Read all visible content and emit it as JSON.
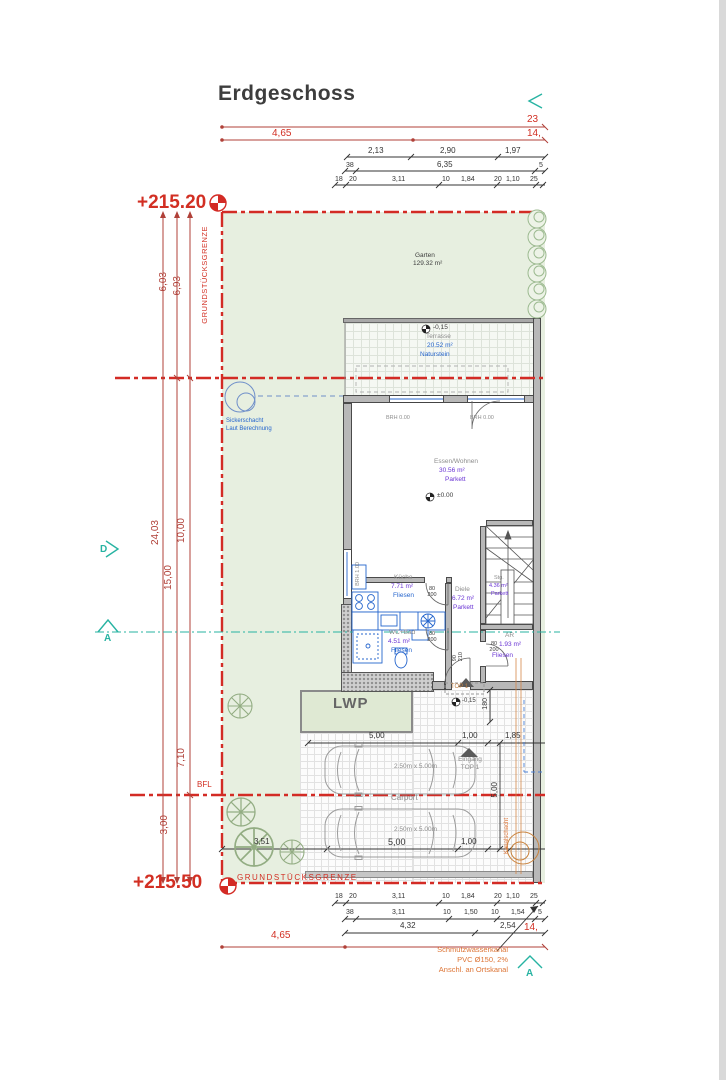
{
  "title": "Erdgeschoss",
  "elevation": {
    "top": "+215.20",
    "bottom": "+215.50"
  },
  "boundary": {
    "label_vertical": "GRUNDSTÜCKSGRENZE",
    "label_bottom": "GRUNDSTÜCKSGRENZE",
    "bfl": "BFL"
  },
  "sections": {
    "d": "D",
    "a_left": "A",
    "a_bottom": "A"
  },
  "garden": {
    "name": "Garten",
    "area": "129.32 m²"
  },
  "terrace": {
    "level": "-0,15",
    "name": "Terrasse",
    "area": "20.52 m²",
    "finish": "Naturstein"
  },
  "rooms": {
    "living": {
      "name": "Essen/Wohnen",
      "area": "30.56 m²",
      "finish": "Parkett",
      "level": "±0.00"
    },
    "kitchen": {
      "name": "Küche",
      "area": "7.71 m²",
      "finish": "Fliesen"
    },
    "hall": {
      "name": "Diele",
      "area": "6.72 m²",
      "finish": "Parkett"
    },
    "stairs": {
      "name": "Stg.",
      "area": "4.36 m²",
      "finish": "Parkett"
    },
    "bath": {
      "name": "WC+Bad",
      "area": "4.51 m²",
      "finish": "Fliesen"
    },
    "storage": {
      "name": "AR",
      "area": "1.93 m²",
      "finish": "Fliesen"
    }
  },
  "windows": {
    "brh0_left": "BRH 0.00",
    "brh0_right": "BRH 0.00",
    "brh1": "BRH 1.00"
  },
  "doors": {
    "kitchen": "80\n200",
    "bath": "80\n200",
    "storage": "80\n200",
    "entry": "90\n210",
    "height180": "180"
  },
  "entry": {
    "top1_box": "TOP 1",
    "top1_level": "-0,15",
    "eingang_line1": "Eingang",
    "eingang_line2": "TOP 1"
  },
  "carport": {
    "label": "Carport",
    "car1": "2.50m x 5.00m",
    "car2": "2.50m x 5.00m"
  },
  "lwp": "LWP",
  "sicker": {
    "line1": "Sickerschacht",
    "line2": "Laut Berechnung"
  },
  "sewer": {
    "line1": "Schmutzwasserkanal",
    "line2": "PVC Ø150, 2%",
    "line3": "Anschl. an Ortskanal",
    "shaft": "Kanalschacht"
  },
  "dims": {
    "top_red": [
      "23",
      "4,65",
      "14,"
    ],
    "top1": [
      "2,13",
      "2,90",
      "1,97"
    ],
    "top2": [
      "38",
      "6,35",
      "5"
    ],
    "top3": [
      "18",
      "20",
      "3,11",
      "10",
      "1,84",
      "20",
      "1,10",
      "25"
    ],
    "left": [
      "6,03",
      "6,93",
      "24,03",
      "15,00",
      "10,00",
      "7,10",
      "3,00"
    ],
    "carport_top": [
      "5,00",
      "1,00",
      "1,85"
    ],
    "carport_bottom": [
      "3,51",
      "5,00",
      "1,00"
    ],
    "carport_right": "5,00",
    "bottom1": [
      "18",
      "20",
      "3,11",
      "10",
      "1,84",
      "20",
      "1,10",
      "25"
    ],
    "bottom2": [
      "38",
      "3,11",
      "10",
      "1,50",
      "10",
      "1,54",
      "5"
    ],
    "bottom3": [
      "4,32",
      "2,54"
    ],
    "bottom_red": [
      "4,65",
      "14,"
    ]
  },
  "colors": {
    "boundary_red": "#d32b25",
    "dim_red": "#b04038",
    "wall_gray": "#b8b8b8",
    "garden_green": "#e7efe0",
    "fixture_blue": "#2565cd",
    "area_purple": "#6a35d4",
    "note_orange": "#dd7435",
    "section_teal": "#27b3a2"
  }
}
